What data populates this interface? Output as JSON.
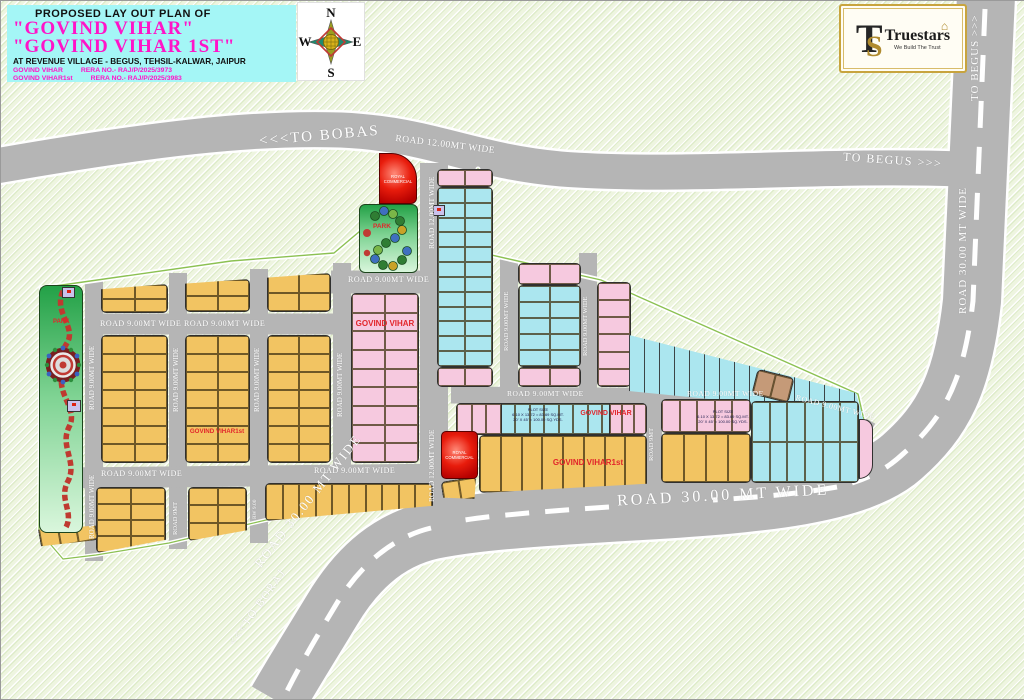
{
  "title_block": {
    "line1": "PROPOSED LAY OUT PLAN OF",
    "name1": "\"GOVIND VIHAR\"",
    "name2": "\"GOVIND VIHAR 1ST\"",
    "address": "AT REVENUE VILLAGE - BEGUS, TEHSIL-KALWAR, JAIPUR",
    "rera1_name": "GOVIND VIHAR",
    "rera1_no": "RERA NO.- RAJ/P/2025/3973",
    "rera2_name": "GOVIND VIHAR1st",
    "rera2_no": "RERA NO.- RAJ/P/2025/3983"
  },
  "compass": {
    "n": "N",
    "e": "E",
    "s": "S",
    "w": "W"
  },
  "logo": {
    "monogram_t": "T",
    "monogram_s": "S",
    "name": "Truestars",
    "tagline": "We Build The Trust",
    "house_icon": "⌂"
  },
  "roads": {
    "to_bobas": "<<<TO BOBAS",
    "to_begus": "TO BEGUS >>>",
    "to_boraj": "<<<TO BORAJ",
    "r30": "ROAD 30.00 MT WIDE",
    "r12": "ROAD 12.00MT WIDE",
    "r9": "ROAD 9.00MT WIDE",
    "r9s": "ROAD 9MT",
    "rw9": "RW 9.00"
  },
  "areas": {
    "govind_vihar": "GOVIND VIHAR",
    "govind_vihar_1st": "GOVIND VIHAR1st",
    "park": "PARK",
    "royal_commercial": "ROYAL COMMERCIAL",
    "plot_size_title": "PLOT SIZE",
    "plot_size_mt": "6.10 X 13.72 = 83.69 SQ.MT.",
    "plot_size_yd": "20' X 45' = 100.00 SQ.YDS."
  },
  "colors": {
    "plot_yellow": "#f2c462",
    "plot_cyan": "#abe6ef",
    "plot_pink": "#f6c9df",
    "road_gray": "#b5b5b5",
    "park_green": "#23a147",
    "commercial_red": "#e81c0c",
    "title_bg": "#a4f6f6",
    "brand_magenta": "#ff14c8",
    "label_red": "#e2262b"
  }
}
